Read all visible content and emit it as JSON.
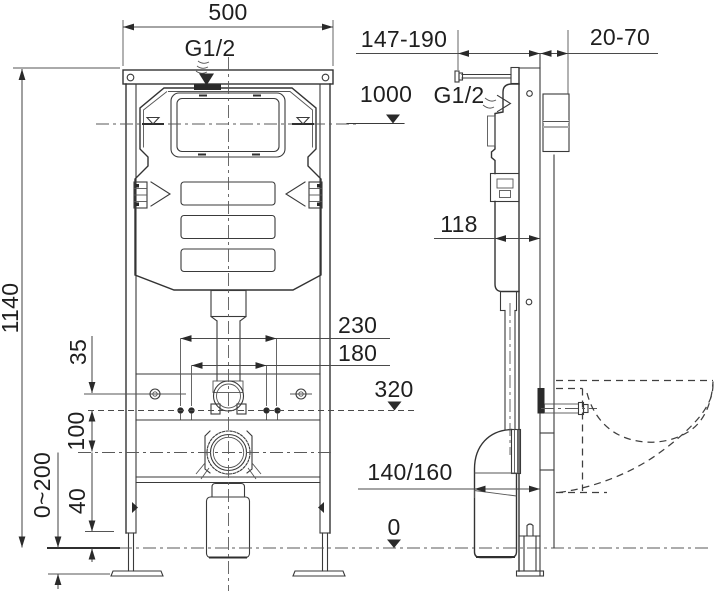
{
  "front_view": {
    "width": "500",
    "water_inlet": "G1/2",
    "height": "1140",
    "screw_line_offset": "35",
    "bolt_to_outlet": "100",
    "outer_bolt_spacing": "230",
    "inner_bolt_spacing": "180",
    "flush_bend_level": "320",
    "foot_height": "40",
    "leg_adjustment": "0~200"
  },
  "side_view": {
    "wall_rod_range": "147-190",
    "wall_covering_range": "20-70",
    "water_level_height": "1000",
    "water_inlet": "G1/2",
    "cistern_depth": "118",
    "outlet_depth": "140/160",
    "floor_level": "0"
  },
  "symbols": {
    "level_marker_icon": "filled triangle marker",
    "water_level_icon": "open nabla water mark",
    "flow_arrow_icon": "wavy supply arrow"
  },
  "colors": {
    "line": "#3a3a3a",
    "text": "#1f1f1f",
    "background": "#ffffff"
  }
}
